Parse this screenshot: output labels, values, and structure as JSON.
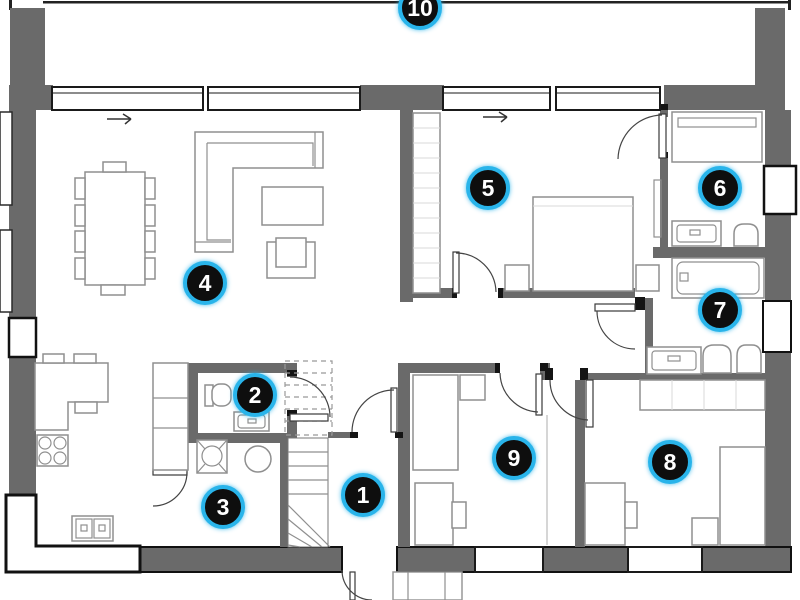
{
  "colors": {
    "wall": "#6a6a6a",
    "badge_background": "#0e0e0e",
    "badge_ring": "#29b4ea",
    "badge_number": "#ffffff",
    "furniture_outline": "#8f8f8f",
    "window_frame": "#1a1a1a"
  },
  "rooms": [
    {
      "label": "1",
      "name": "entrance-hall"
    },
    {
      "label": "2",
      "name": "wc"
    },
    {
      "label": "3",
      "name": "kitchen"
    },
    {
      "label": "4",
      "name": "living-dining-room"
    },
    {
      "label": "5",
      "name": "bedroom-master"
    },
    {
      "label": "6",
      "name": "toilet-room"
    },
    {
      "label": "7",
      "name": "bathroom"
    },
    {
      "label": "8",
      "name": "bedroom-right"
    },
    {
      "label": "9",
      "name": "bedroom-center"
    },
    {
      "label": "10",
      "name": "terrace"
    }
  ]
}
